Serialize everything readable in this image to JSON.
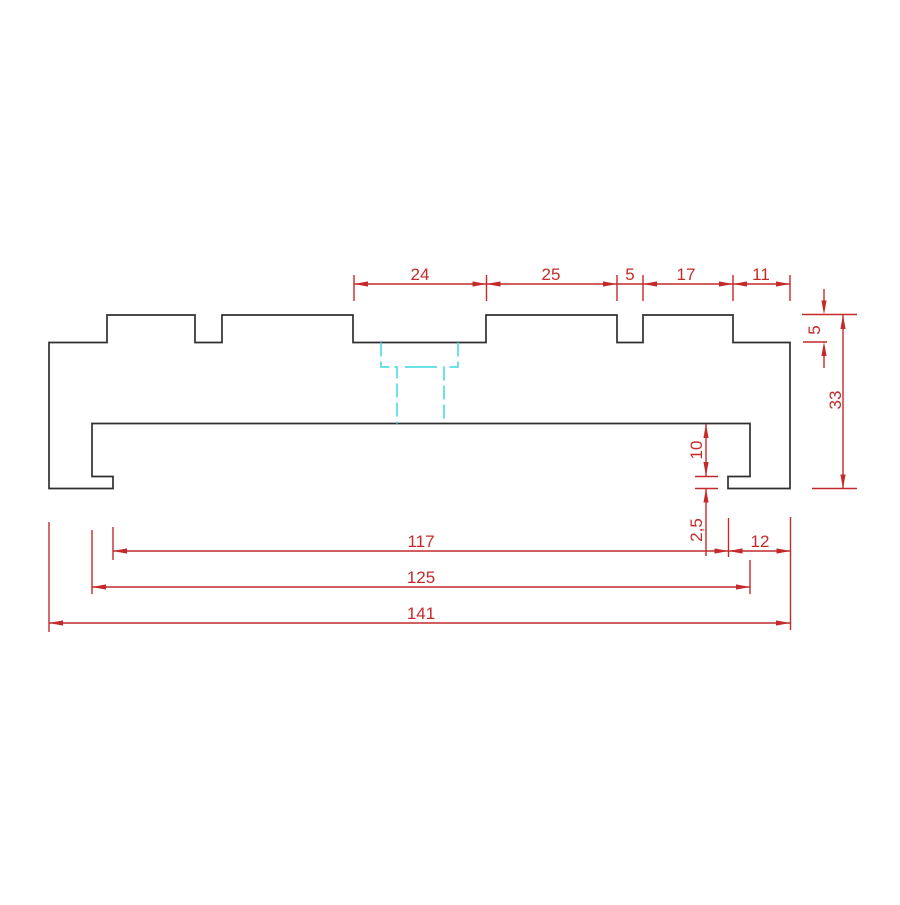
{
  "drawing": {
    "type": "technical-cross-section",
    "units_note": "mm",
    "colors": {
      "background": "#ffffff",
      "outline": "#2f2f2f",
      "dimension": "#c42a2a",
      "hidden_detail": "#55dde2"
    },
    "dimensions": {
      "top_chain": {
        "d24": "24",
        "d25": "25",
        "d5": "5",
        "d17": "17",
        "d11": "11"
      },
      "right": {
        "notch_depth": "5",
        "overall_height": "33"
      },
      "inner": {
        "web_to_step": "10",
        "flange_thickness": "2,5",
        "foot_width": "12"
      },
      "bottom_chain": {
        "d117": "117",
        "d125": "125",
        "d141": "141"
      }
    }
  }
}
